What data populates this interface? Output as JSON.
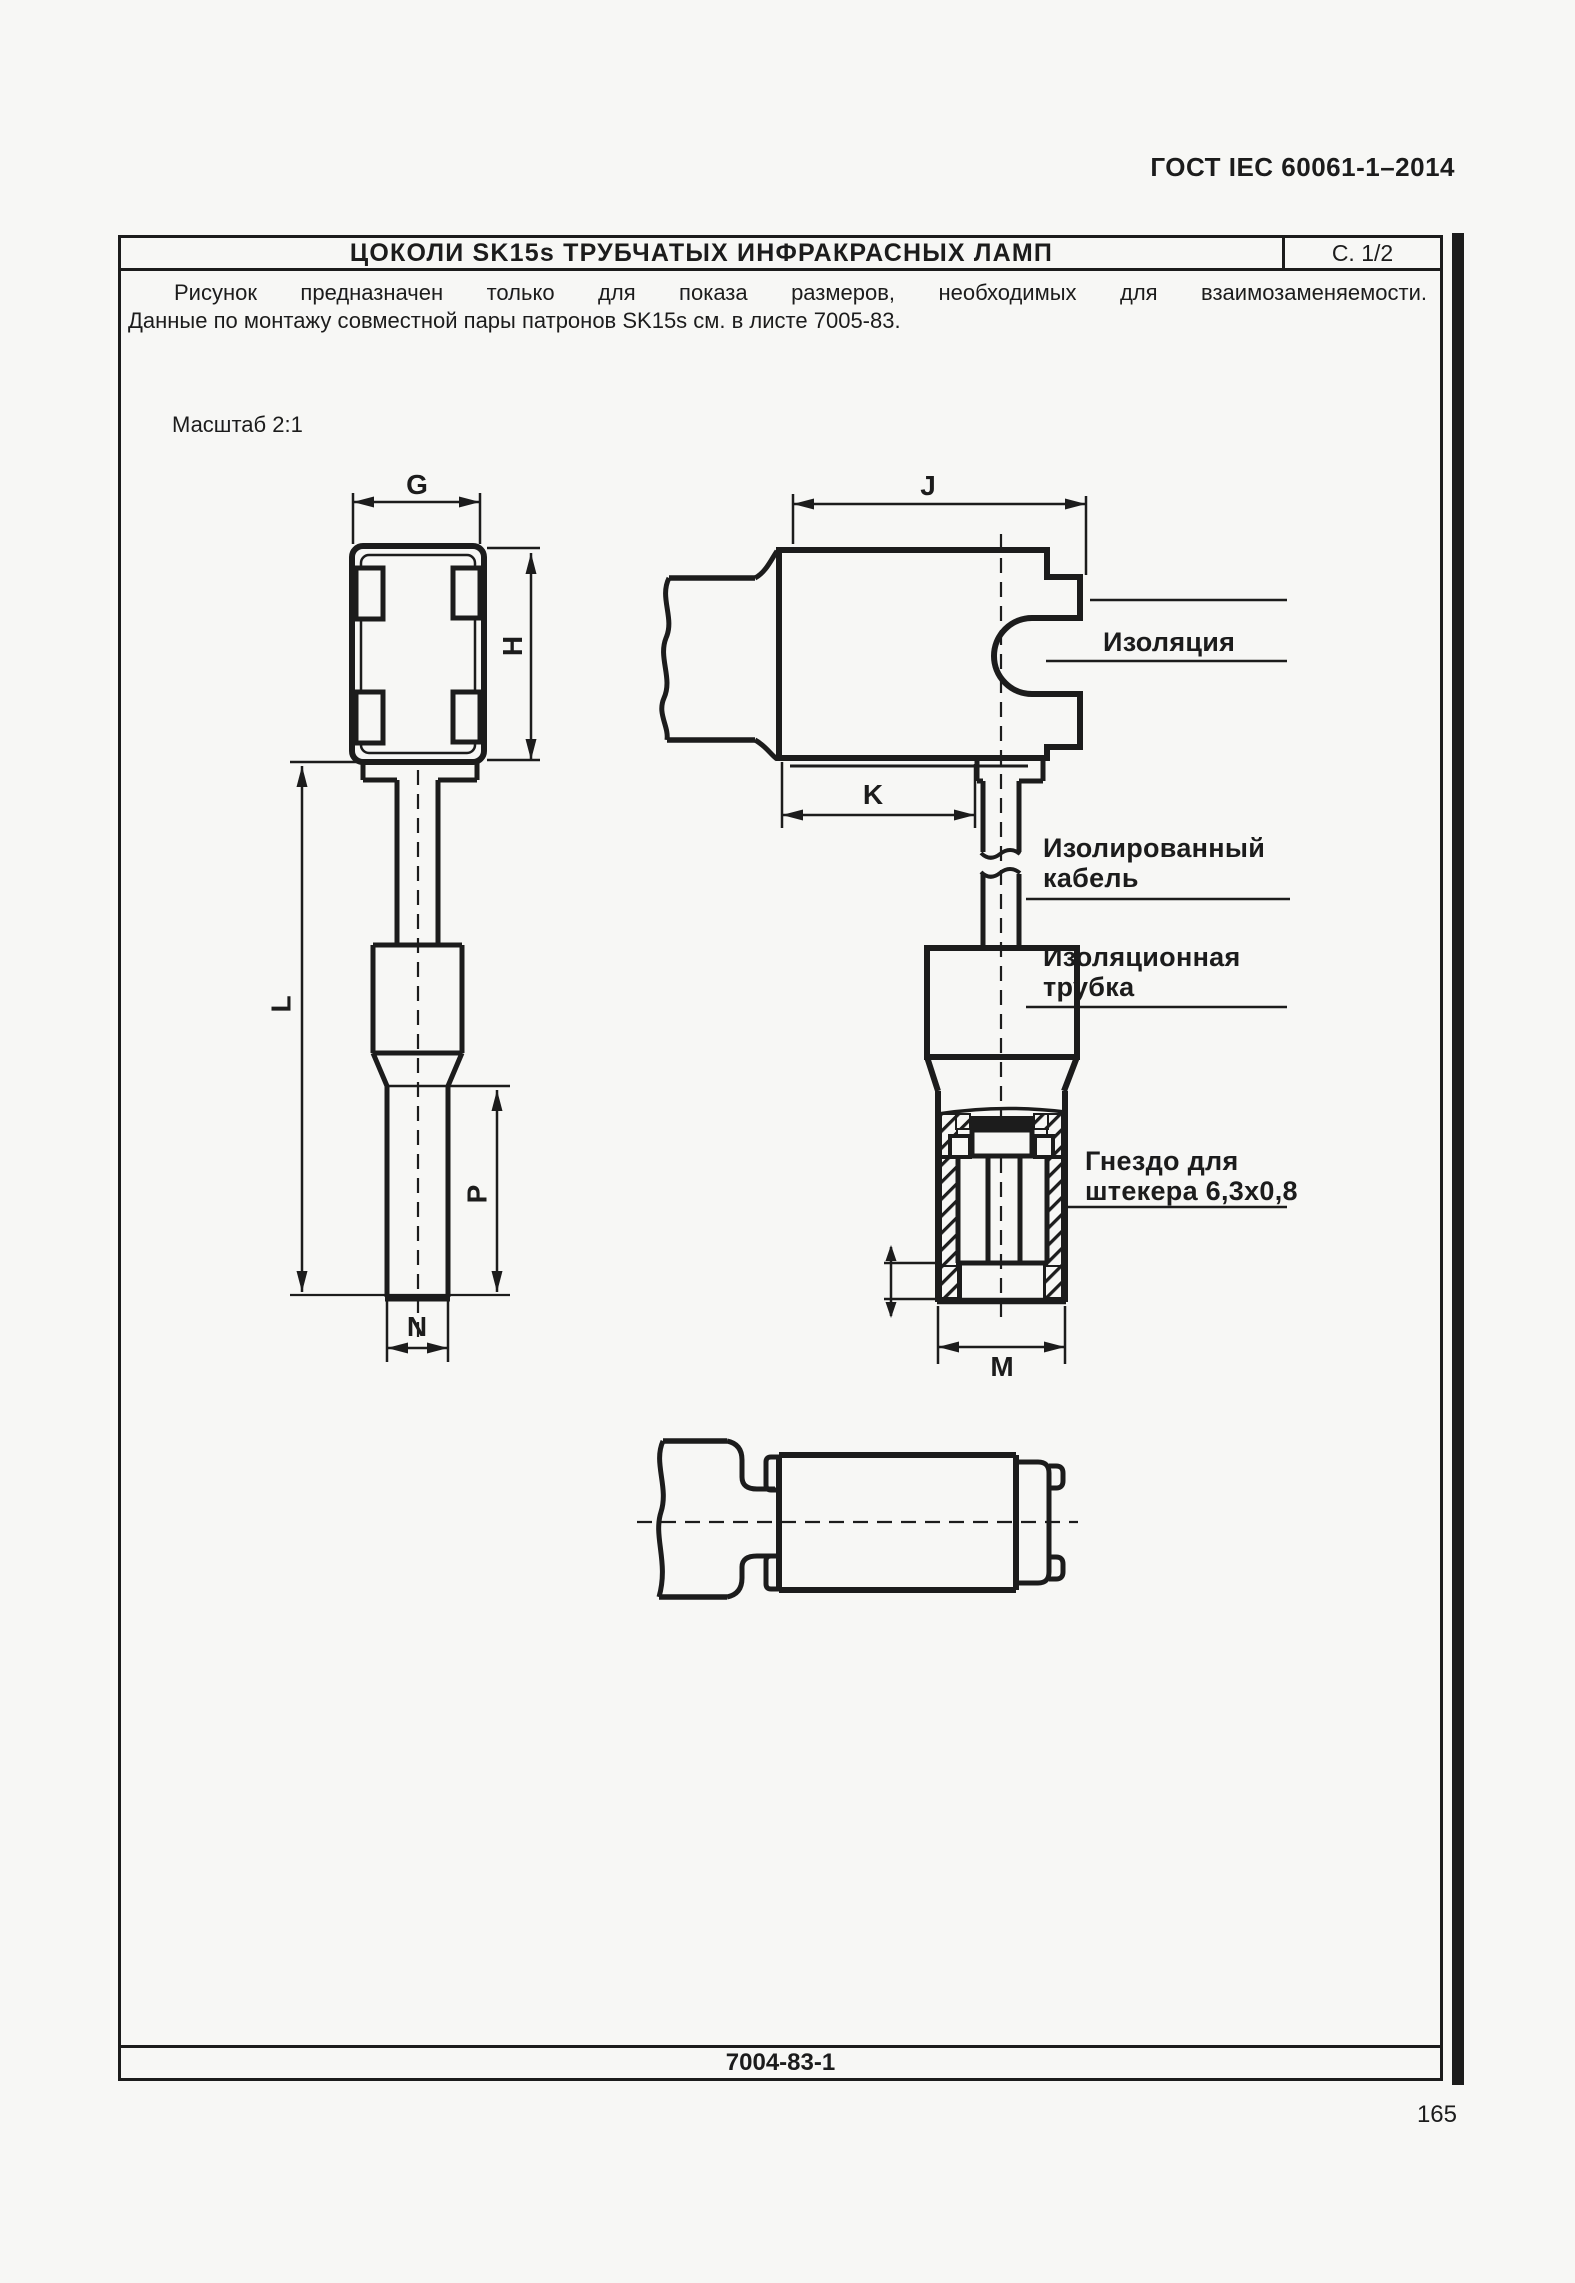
{
  "header": {
    "standard": "ГОСТ IEC 60061-1–2014"
  },
  "sheet": {
    "title": "ЦОКОЛИ SK15s ТРУБЧАТЫХ ИНФРАКРАСНЫХ ЛАМП",
    "page_ref": "С. 1/2",
    "note_line1": "Рисунок предназначен только для показа размеров, необходимых для взаимозаменяемости.",
    "note_line2": "Данные по монтажу совместной пары патронов SK15s см. в листе 7005-83.",
    "scale_note": "Масштаб 2:1",
    "doc_number": "7004-83-1"
  },
  "dims": {
    "G": "G",
    "H": "H",
    "J": "J",
    "K": "K",
    "L": "L",
    "M": "M",
    "N": "N",
    "P": "P"
  },
  "callouts": {
    "insulation": "Изоляция",
    "cable_line1": "Изолированный",
    "cable_line2": "кабель",
    "tube_line1": "Изоляционная",
    "tube_line2": "трубка",
    "socket_line1": "Гнездо для",
    "socket_line2": "штекера 6,3х0,8"
  },
  "page": {
    "number": "165"
  },
  "ink_color": "#1c1c1c",
  "paper_color": "#f7f7f5"
}
